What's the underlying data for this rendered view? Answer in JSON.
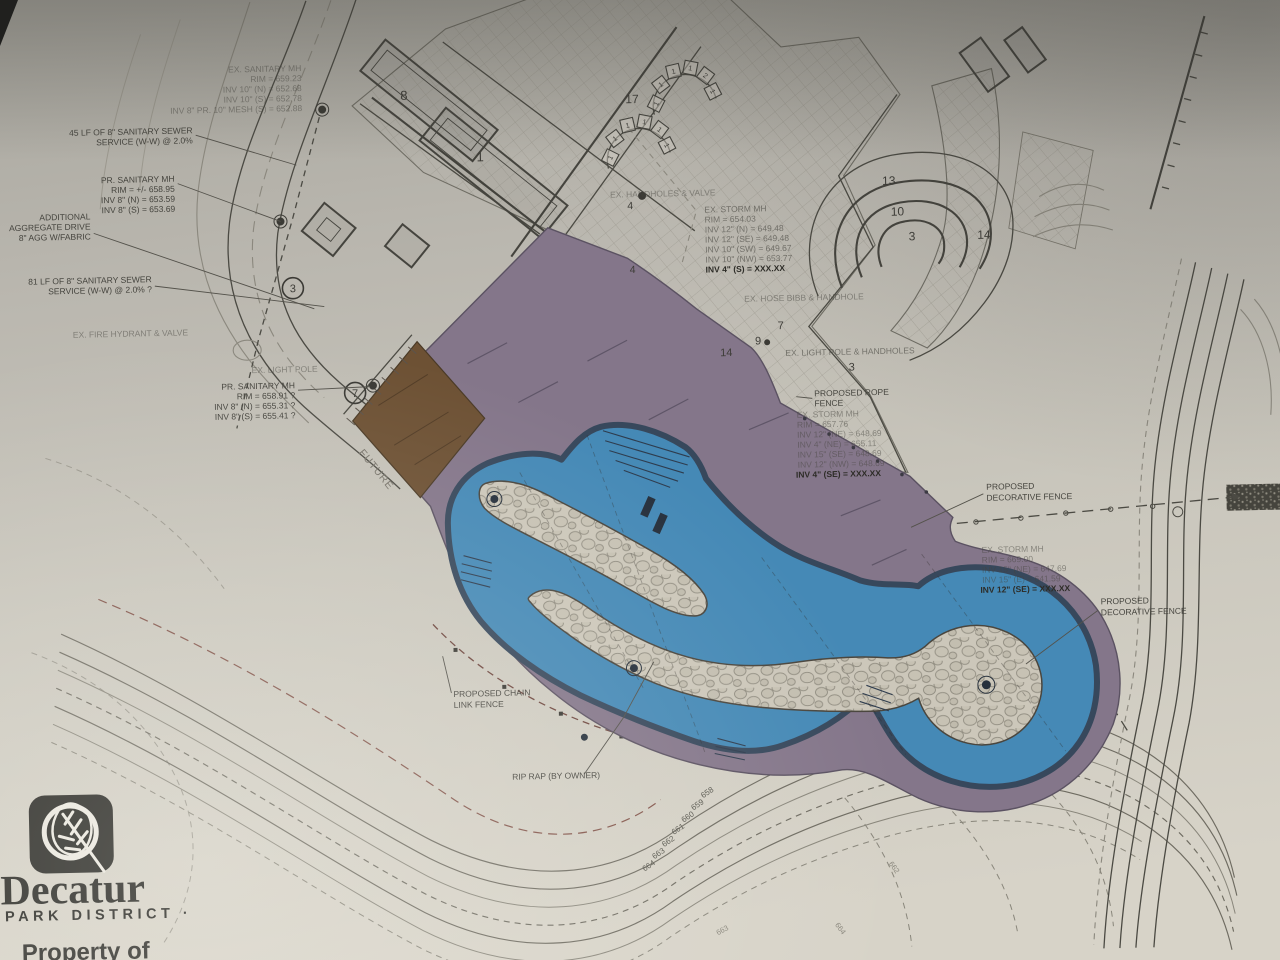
{
  "logo": {
    "name": "Decatur",
    "subtitle": "PARK DISTRICT ·",
    "property_line": "Property of",
    "property_line2": "atur Park District"
  },
  "notes": {
    "ex_sanitary_mh": {
      "lines": [
        "EX. SANITARY MH",
        "RIM = 659.23",
        "INV 10\" (N) = 652.68",
        "INV 10\" (S) = 652.78",
        "INV 8\" PR. 10\" MESH (S) = 652.88"
      ]
    },
    "sewer_45": {
      "lines": [
        "45 LF OF 8\" SANITARY SEWER",
        "SERVICE (W-W) @ 2.0%"
      ]
    },
    "pr_sanitary_mh_1": {
      "lines": [
        "PR. SANITARY MH",
        "RIM = +/- 658.95",
        "INV 8\" (N) = 653.59",
        "INV 8\" (S) = 653.69"
      ]
    },
    "aggregate_drive": {
      "lines": [
        "ADDITIONAL",
        "AGGREGATE DRIVE",
        "8\" AGG W/FABRIC"
      ]
    },
    "sewer_81": {
      "lines": [
        "81 LF OF 8\" SANITARY SEWER",
        "SERVICE (W-W) @ 2.0% ?"
      ]
    },
    "fire_hydrant": "EX. FIRE HYDRANT & VALVE",
    "light_pole": "EX. LIGHT POLE",
    "pr_sanitary_mh_2": {
      "lines": [
        "PR. SANITARY MH",
        "RIM = 658.91 ?",
        "INV 8\" (N) = 655.31 ?",
        "INV 8\" (S) = 655.41 ?"
      ]
    },
    "future": "FUTURE",
    "handholes": "EX. HANDHOLES & VALVE",
    "storm_mh_top": {
      "lines": [
        "EX. STORM MH",
        "RIM = 654.03",
        "INV 12\" (N) = 649.48",
        "INV 12\" (SE) = 649.48",
        "INV 10\" (SW) = 649.67",
        "INV 10\" (NW) = 653.77",
        "INV 4\" (S) = XXX.XX"
      ]
    },
    "hose_bibb": "EX. HOSE BIBB & HANDHOLE",
    "light_pole_handholes": "EX. LIGHT POLE & HANDHOLES",
    "rope_fence": {
      "lines": [
        "PROPOSED ROPE",
        "FENCE"
      ]
    },
    "storm_mh_mid": {
      "lines": [
        "EX. STORM MH",
        "RIM = 657.76",
        "INV 12\" (NE) = 648.69",
        "INV 4\" (NE) = 655.11",
        "INV 15\" (SE) = 648.69",
        "INV 12\" (NW) = 648.69",
        "INV 4\" (SE) = XXX.XX"
      ]
    },
    "dec_fence": {
      "lines": [
        "PROPOSED",
        "DECORATIVE FENCE"
      ]
    },
    "storm_mh_right": {
      "lines": [
        "EX. STORM MH",
        "RIM = 669.00",
        "INV 15\" (NE) = 647.69",
        "INV 15\" (E) = 641.59",
        "INV 12\" (SE) = XXX.XX"
      ]
    },
    "chain_link": {
      "lines": [
        "PROPOSED CHAIN",
        "LINK FENCE"
      ]
    },
    "rip_rap": "RIP RAP (BY OWNER)"
  },
  "area_numbers": {
    "b8": "8",
    "b1": "1",
    "w17": "17",
    "t13": "13",
    "t10": "10",
    "t3": "3",
    "t14": "14",
    "p4a": "4",
    "p4b": "4",
    "p7": "7",
    "p9": "9",
    "p14": "14",
    "p3": "3",
    "c3": "3",
    "c7": "7"
  },
  "chairs": {
    "a": [
      "1",
      "1",
      "1",
      "1",
      "2",
      "1"
    ],
    "b": [
      "1",
      "1",
      "1",
      "1",
      "1",
      "1"
    ]
  },
  "contours": {
    "left": [
      "658",
      "659",
      "660",
      "661",
      "662",
      "663",
      "664"
    ],
    "right": [
      "662",
      "663",
      "664"
    ]
  },
  "colors": {
    "paper": "#c9c5bc",
    "deck": "#84768a",
    "water": "#4589b6",
    "water_edge": "#37485c",
    "future_building": "#6d5134",
    "ink": "#45443e",
    "faint_ink": "#8b887e",
    "erosion": "#8a5a50"
  }
}
